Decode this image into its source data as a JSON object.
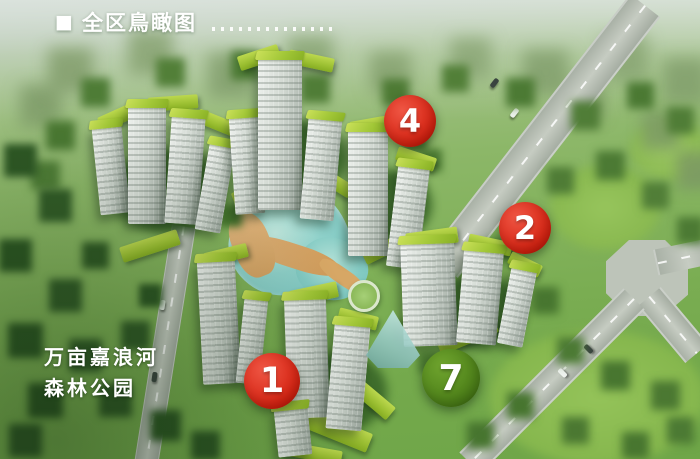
{
  "header": {
    "bullet": "■",
    "title": "全区鳥瞰图"
  },
  "park_label": {
    "line1": "万亩嘉浪河",
    "line2": "森林公园"
  },
  "markers": [
    {
      "label": "4",
      "cx": 410,
      "cy": 121,
      "size": 52,
      "color": "#d3200f",
      "color_light": "#ef5644",
      "color_dark": "#a91105"
    },
    {
      "label": "2",
      "cx": 525,
      "cy": 228,
      "size": 52,
      "color": "#d3200f",
      "color_light": "#ef5644",
      "color_dark": "#a91105"
    },
    {
      "label": "1",
      "cx": 272,
      "cy": 381,
      "size": 56,
      "color": "#d3200f",
      "color_light": "#ef5644",
      "color_dark": "#a91105"
    },
    {
      "label": "7",
      "cx": 451,
      "cy": 378,
      "size": 58,
      "color": "#4a7d17",
      "color_light": "#6fa42e",
      "color_dark": "#35600e"
    }
  ],
  "palette": {
    "marker_red": "#d3200f",
    "marker_green": "#4a7d17",
    "roof_green": "#a3c838",
    "lake_teal": "#84cbc4",
    "road_gray": "#b5bcb1",
    "tree_green": "#3c6b2d"
  }
}
